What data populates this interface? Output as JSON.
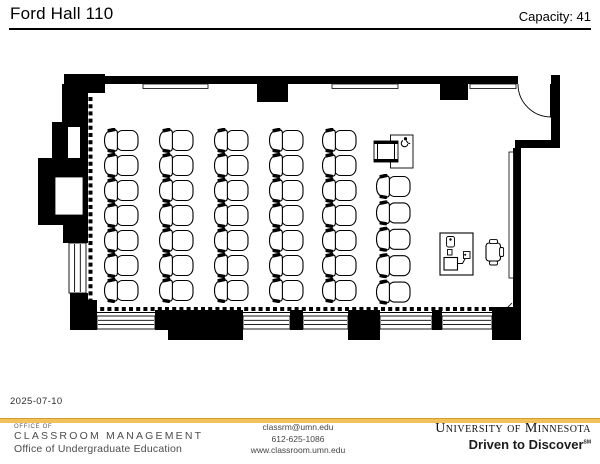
{
  "header": {
    "room_title": "Ford Hall 110",
    "capacity": "Capacity: 41"
  },
  "floorplan": {
    "seating": {
      "columns": [
        {
          "name": "column-1",
          "chairs": 7
        },
        {
          "name": "column-2",
          "chairs": 7
        },
        {
          "name": "column-3",
          "chairs": 7
        },
        {
          "name": "column-4",
          "chairs": 7
        },
        {
          "name": "column-5",
          "chairs": 7
        },
        {
          "name": "column-6",
          "chairs": 5
        }
      ],
      "wheelchair_station_icon": "wheelchair-icon",
      "instructor_station_icon": "instructor-equipment-table",
      "door_icon": "door-swing-arc"
    }
  },
  "footer": {
    "date": "2025-07-10",
    "office": {
      "eyebrow": "OFFICE OF",
      "name": "CLASSROOM MANAGEMENT",
      "sub": "Office of Undergraduate Education"
    },
    "contact": {
      "email": "classrm@umn.edu",
      "phone": "612-625-1086",
      "website": "www.classroom.umn.edu"
    },
    "brand": {
      "university": "University of Minnesota",
      "tagline": "Driven to Discover",
      "tagline_mark": "SM"
    },
    "colors": {
      "gold": "#F1C15C",
      "wall": "#000000"
    }
  }
}
